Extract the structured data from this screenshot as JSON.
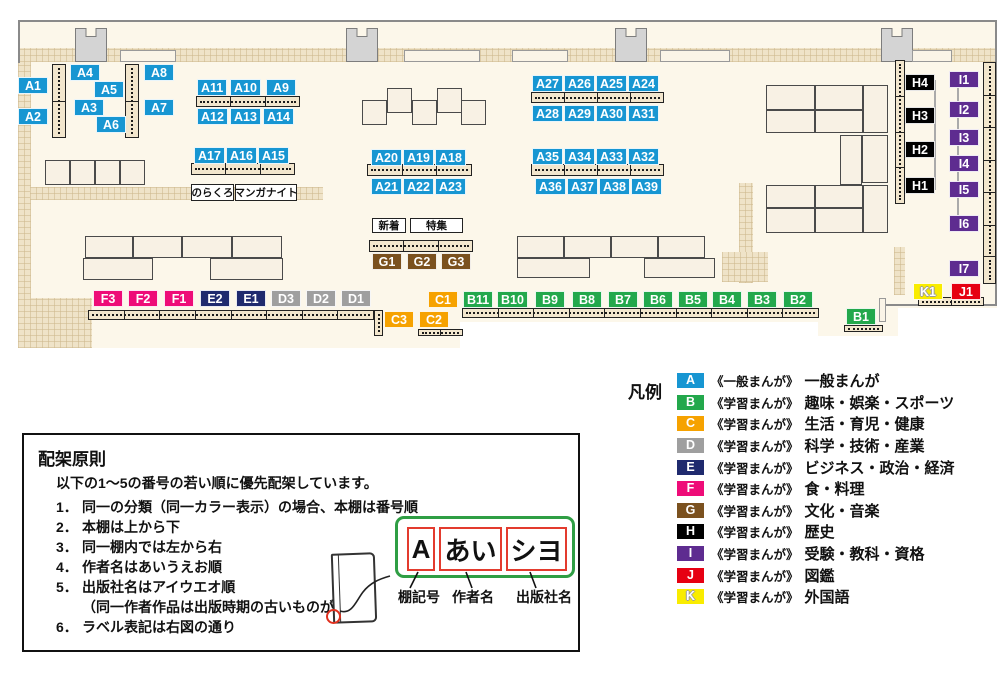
{
  "colors": {
    "A": "#1796d2",
    "B": "#23a84c",
    "C": "#f6a200",
    "D": "#9f9f9f",
    "E": "#1f2a6e",
    "F": "#ee0c78",
    "G": "#7b511f",
    "H": "#000000",
    "I": "#5e2c90",
    "J": "#e60012",
    "K": "#f9ec00"
  },
  "map": {
    "markers": [
      {
        "id": "A1",
        "x": 18,
        "y": 77
      },
      {
        "id": "A2",
        "x": 18,
        "y": 108
      },
      {
        "id": "A4",
        "x": 70,
        "y": 64
      },
      {
        "id": "A5",
        "x": 94,
        "y": 81
      },
      {
        "id": "A3",
        "x": 74,
        "y": 99
      },
      {
        "id": "A6",
        "x": 96,
        "y": 116
      },
      {
        "id": "A8",
        "x": 144,
        "y": 64
      },
      {
        "id": "A7",
        "x": 144,
        "y": 99
      },
      {
        "id": "A11",
        "x": 197,
        "y": 79
      },
      {
        "id": "A10",
        "x": 230,
        "y": 79
      },
      {
        "id": "A9",
        "x": 266,
        "y": 79
      },
      {
        "id": "A12",
        "x": 197,
        "y": 108
      },
      {
        "id": "A13",
        "x": 230,
        "y": 108
      },
      {
        "id": "A14",
        "x": 263,
        "y": 108
      },
      {
        "id": "A17",
        "x": 194,
        "y": 147
      },
      {
        "id": "A16",
        "x": 226,
        "y": 147
      },
      {
        "id": "A15",
        "x": 258,
        "y": 147
      },
      {
        "id": "A20",
        "x": 371,
        "y": 149
      },
      {
        "id": "A19",
        "x": 403,
        "y": 149
      },
      {
        "id": "A18",
        "x": 435,
        "y": 149
      },
      {
        "id": "A21",
        "x": 371,
        "y": 178
      },
      {
        "id": "A22",
        "x": 403,
        "y": 178
      },
      {
        "id": "A23",
        "x": 435,
        "y": 178
      },
      {
        "id": "A27",
        "x": 532,
        "y": 75
      },
      {
        "id": "A26",
        "x": 564,
        "y": 75
      },
      {
        "id": "A25",
        "x": 596,
        "y": 75
      },
      {
        "id": "A24",
        "x": 628,
        "y": 75
      },
      {
        "id": "A28",
        "x": 532,
        "y": 105
      },
      {
        "id": "A29",
        "x": 564,
        "y": 105
      },
      {
        "id": "A30",
        "x": 596,
        "y": 105
      },
      {
        "id": "A31",
        "x": 628,
        "y": 105
      },
      {
        "id": "A35",
        "x": 532,
        "y": 148
      },
      {
        "id": "A34",
        "x": 564,
        "y": 148
      },
      {
        "id": "A33",
        "x": 596,
        "y": 148
      },
      {
        "id": "A32",
        "x": 628,
        "y": 148
      },
      {
        "id": "A36",
        "x": 535,
        "y": 178
      },
      {
        "id": "A37",
        "x": 567,
        "y": 178
      },
      {
        "id": "A38",
        "x": 599,
        "y": 178
      },
      {
        "id": "A39",
        "x": 631,
        "y": 178
      },
      {
        "id": "G1",
        "x": 372,
        "y": 253
      },
      {
        "id": "G2",
        "x": 407,
        "y": 253
      },
      {
        "id": "G3",
        "x": 441,
        "y": 253
      },
      {
        "id": "F3",
        "x": 93,
        "y": 290
      },
      {
        "id": "F2",
        "x": 128,
        "y": 290
      },
      {
        "id": "F1",
        "x": 164,
        "y": 290
      },
      {
        "id": "E2",
        "x": 200,
        "y": 290
      },
      {
        "id": "E1",
        "x": 236,
        "y": 290
      },
      {
        "id": "D3",
        "x": 271,
        "y": 290
      },
      {
        "id": "D2",
        "x": 306,
        "y": 290
      },
      {
        "id": "D1",
        "x": 341,
        "y": 290
      },
      {
        "id": "C1",
        "x": 428,
        "y": 291
      },
      {
        "id": "C3",
        "x": 384,
        "y": 311
      },
      {
        "id": "C2",
        "x": 419,
        "y": 311
      },
      {
        "id": "B11",
        "x": 463,
        "y": 291
      },
      {
        "id": "B10",
        "x": 497,
        "y": 291
      },
      {
        "id": "B9",
        "x": 535,
        "y": 291
      },
      {
        "id": "B8",
        "x": 572,
        "y": 291
      },
      {
        "id": "B7",
        "x": 608,
        "y": 291
      },
      {
        "id": "B6",
        "x": 643,
        "y": 291
      },
      {
        "id": "B5",
        "x": 678,
        "y": 291
      },
      {
        "id": "B4",
        "x": 712,
        "y": 291
      },
      {
        "id": "B3",
        "x": 747,
        "y": 291
      },
      {
        "id": "B2",
        "x": 783,
        "y": 291
      },
      {
        "id": "B1",
        "x": 846,
        "y": 308
      },
      {
        "id": "H4",
        "x": 905,
        "y": 74
      },
      {
        "id": "H3",
        "x": 905,
        "y": 107
      },
      {
        "id": "H2",
        "x": 905,
        "y": 141
      },
      {
        "id": "H1",
        "x": 905,
        "y": 177
      },
      {
        "id": "I1",
        "x": 949,
        "y": 71
      },
      {
        "id": "I2",
        "x": 949,
        "y": 101
      },
      {
        "id": "I3",
        "x": 949,
        "y": 129
      },
      {
        "id": "I4",
        "x": 949,
        "y": 155
      },
      {
        "id": "I5",
        "x": 949,
        "y": 181
      },
      {
        "id": "I6",
        "x": 949,
        "y": 215
      },
      {
        "id": "I7",
        "x": 949,
        "y": 260
      },
      {
        "id": "K1",
        "x": 913,
        "y": 283
      },
      {
        "id": "J1",
        "x": 951,
        "y": 283
      }
    ],
    "boxes": [
      {
        "id": "norakuro",
        "text": "のらくろ",
        "x": 191,
        "y": 184,
        "w": 43,
        "h": 17
      },
      {
        "id": "manga-night",
        "text": "マンガナイト",
        "x": 235,
        "y": 184,
        "w": 62,
        "h": 17
      },
      {
        "id": "new-arrivals",
        "text": "新着",
        "x": 372,
        "y": 218,
        "w": 34,
        "h": 15
      },
      {
        "id": "special-feature",
        "text": "特集",
        "x": 410,
        "y": 218,
        "w": 53,
        "h": 15
      }
    ]
  },
  "legend": {
    "title": "凡例",
    "items": [
      {
        "code": "A",
        "type": "《一般まんが》",
        "category": "一般まんが"
      },
      {
        "code": "B",
        "type": "《学習まんが》",
        "category": "趣味・娯楽・スポーツ"
      },
      {
        "code": "C",
        "type": "《学習まんが》",
        "category": "生活・育児・健康"
      },
      {
        "code": "D",
        "type": "《学習まんが》",
        "category": "科学・技術・産業"
      },
      {
        "code": "E",
        "type": "《学習まんが》",
        "category": "ビジネス・政治・経済"
      },
      {
        "code": "F",
        "type": "《学習まんが》",
        "category": "食・料理"
      },
      {
        "code": "G",
        "type": "《学習まんが》",
        "category": "文化・音楽"
      },
      {
        "code": "H",
        "type": "《学習まんが》",
        "category": "歴史"
      },
      {
        "code": "I",
        "type": "《学習まんが》",
        "category": "受験・教科・資格"
      },
      {
        "code": "J",
        "type": "《学習まんが》",
        "category": "図鑑"
      },
      {
        "code": "K",
        "type": "《学習まんが》",
        "category": "外国語"
      }
    ]
  },
  "principles": {
    "title": "配架原則",
    "intro": "以下の1～5の番号の若い順に優先配架しています。",
    "items": [
      {
        "n": "1．",
        "t": "同一の分類（同一カラー表示）の場合、本棚は番号順"
      },
      {
        "n": "2．",
        "t": "本棚は上から下"
      },
      {
        "n": "3．",
        "t": "同一棚内では左から右"
      },
      {
        "n": "4．",
        "t": "作者名はあいうえお順"
      },
      {
        "n": "5．",
        "t": "出版社名はアイウエオ順"
      },
      {
        "n": "",
        "t": "（同一作者作品は出版時期の古いものが先）"
      },
      {
        "n": "6．",
        "t": "ラベル表記は右図の通り"
      }
    ],
    "label_example": {
      "shelf_code": "A",
      "author": "あい",
      "publisher": "シヨ",
      "captions": [
        "棚記号",
        "作者名",
        "出版社名"
      ]
    }
  }
}
